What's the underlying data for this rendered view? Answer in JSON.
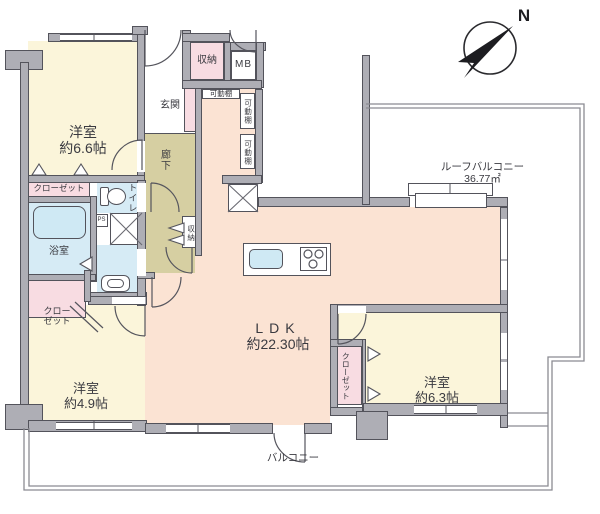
{
  "compass": {
    "north": "N"
  },
  "rooms": {
    "bedroom_66": {
      "name": "洋室",
      "size": "約6.6帖"
    },
    "bedroom_49": {
      "name": "洋室",
      "size": "約4.9帖"
    },
    "bedroom_63": {
      "name": "洋室",
      "size": "約6.3帖"
    },
    "ldk": {
      "name": "LDK",
      "size": "約22.30帖"
    },
    "entrance": {
      "label": "玄関"
    },
    "hallway": {
      "label": "廊下"
    },
    "bathroom": {
      "label": "浴室"
    },
    "toilet": {
      "label": "トイレ"
    },
    "storage_top": {
      "label": "収納"
    },
    "storage_hall": {
      "label": "収納"
    },
    "meter_box": {
      "label": "MB"
    },
    "pipe_space": {
      "label": "PS"
    },
    "shelves": [
      {
        "label": "可動棚"
      },
      {
        "label": "可動棚"
      },
      {
        "label": "可動棚"
      }
    ],
    "closet_top": {
      "label": "クローゼット"
    },
    "closet_mid": {
      "line1": "クロー",
      "line2": "ゼット"
    },
    "closet_63": {
      "label": "クローゼット"
    }
  },
  "balconies": {
    "roof": {
      "label": "ルーフバルコニー",
      "area": "36.77㎡"
    },
    "south": {
      "label": "バルコニー"
    }
  },
  "colors": {
    "room_cream": "#fbf5da",
    "ldk_peach": "#fbe3d3",
    "closet_pink": "#f8dce2",
    "wet_blue": "#d6ebf5",
    "hall_olive": "#d6cfa2",
    "wall_grey": "#aeaeb5",
    "line_grey": "#8b8b92"
  }
}
